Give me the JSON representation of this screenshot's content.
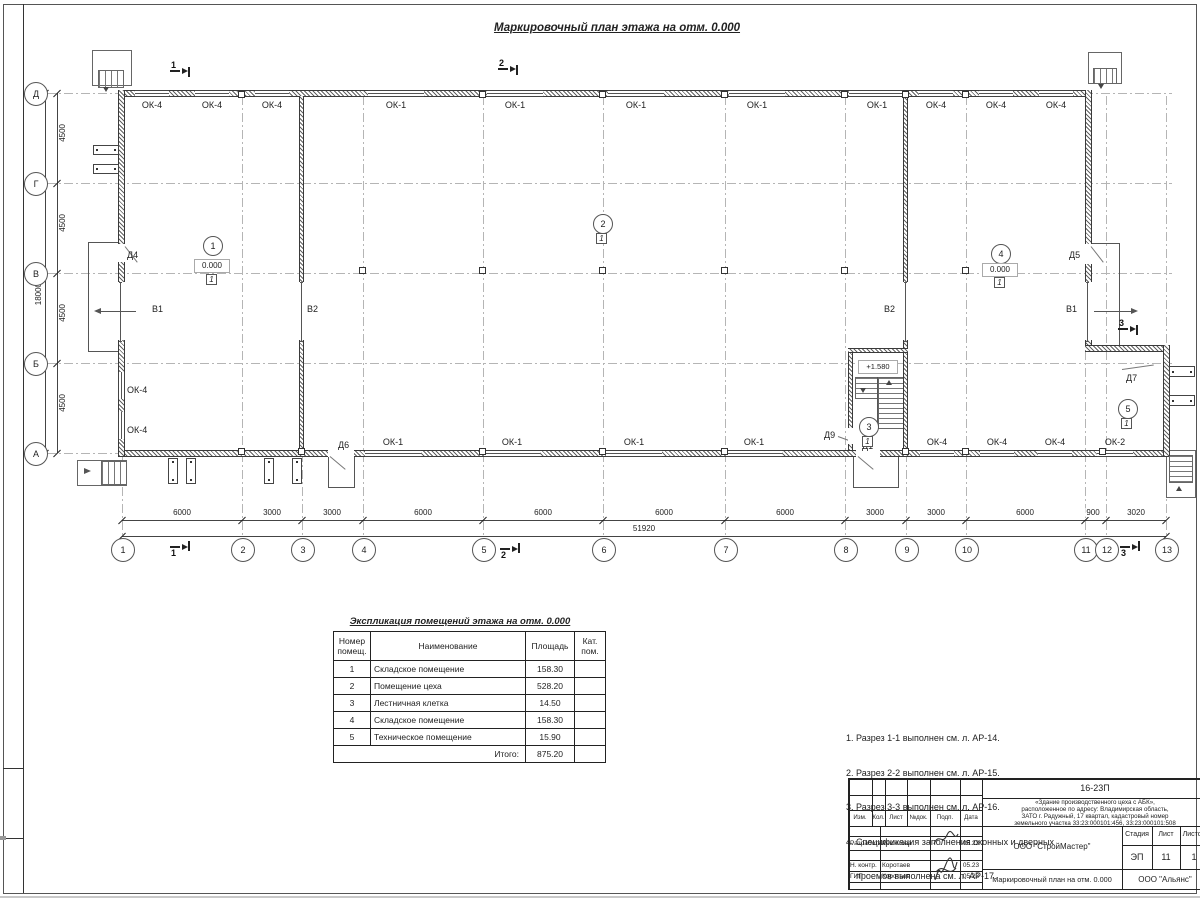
{
  "title": "Маркировочный план этажа на отм. 0.000",
  "plan": {
    "axes_rows": [
      "Д",
      "Г",
      "В",
      "Б",
      "А"
    ],
    "axes_cols": [
      "1",
      "2",
      "3",
      "4",
      "5",
      "6",
      "7",
      "8",
      "9",
      "10",
      "11",
      "12",
      "13"
    ],
    "dims_left": [
      "4500",
      "4500",
      "4500",
      "4500"
    ],
    "dim_left_total": "18000",
    "dims_bottom": [
      "6000",
      "3000",
      "3000",
      "6000",
      "6000",
      "6000",
      "6000",
      "3000",
      "3000",
      "6000",
      "900",
      "3020"
    ],
    "dim_bottom_total": "51920",
    "windows_top": [
      "ОК-4",
      "ОК-4",
      "ОК-4",
      "ОК-1",
      "ОК-1",
      "ОК-1",
      "ОК-1",
      "ОК-1",
      "ОК-4",
      "ОК-4",
      "ОК-4"
    ],
    "windows_bottom": [
      "ОК-1",
      "ОК-1",
      "ОК-1",
      "ОК-1",
      "ОК-4",
      "ОК-4",
      "ОК-4",
      "ОК-2"
    ],
    "windows_left": [
      "ОК-4",
      "ОК-4"
    ],
    "doors": {
      "d1": "Д1",
      "d4": "Д4",
      "d5": "Д5",
      "d6": "Д6",
      "d7": "Д7",
      "d9": "Д9"
    },
    "gate_b1": "В1",
    "gate_b2": "В2",
    "rooms": [
      {
        "num": "1",
        "elev": "0.000",
        "floor": "1"
      },
      {
        "num": "2",
        "floor": "1"
      },
      {
        "num": "3",
        "floor": "1"
      },
      {
        "num": "4",
        "elev": "0.000",
        "floor": "1"
      },
      {
        "num": "5",
        "floor": "1"
      }
    ],
    "stair_elev": "+1.580",
    "sections": {
      "s1": "1",
      "s2": "2",
      "s3": "3"
    }
  },
  "table": {
    "title": "Экспликация помещений этажа на отм. 0.000",
    "headers": {
      "num": "Номер помещ.",
      "name": "Наименование",
      "area": "Площадь",
      "cat": "Кат. пом."
    },
    "rows": [
      {
        "num": "1",
        "name": "Складское помещение",
        "area": "158.30"
      },
      {
        "num": "2",
        "name": "Помещение цеха",
        "area": "528.20"
      },
      {
        "num": "3",
        "name": "Лестничная клетка",
        "area": "14.50"
      },
      {
        "num": "4",
        "name": "Складское помещение",
        "area": "158.30"
      },
      {
        "num": "5",
        "name": "Техническое помещение",
        "area": "15.90"
      }
    ],
    "total_label": "Итого:",
    "total_value": "875.20"
  },
  "notes": [
    "1. Разрез 1-1 выполнен см. л. АР-14.",
    "2. Разрез 2-2 выполнен см. л. АР-15.",
    "3. Разрез 3-3 выполнен см. л. АР-16.",
    "4. Спецификация заполнения оконных и дверных",
    "    проемов выполнена см. л. АР-17.",
    "5. Экспликация полов выполнена см. л. АР-18."
  ],
  "titleblock": {
    "doc_number": "16-23П",
    "desc_lines": [
      "«Здание производственного цеха с АБК»,",
      "расположенное по адресу: Владимирская область,",
      "ЗАТО г. Радужный, 17 квартал, кадастровый номер",
      "земельного участка 33:23:000101:456, 33:23:000101:508"
    ],
    "header_cells": [
      "Изм.",
      "Кол.",
      "Лист",
      "№док.",
      "Подп.",
      "Дата"
    ],
    "rows": [
      {
        "role": "Разработал",
        "name": "Решетова",
        "date": "05.23"
      },
      {
        "role": "Н. контр.",
        "name": "Коротаев",
        "date": "05.23"
      },
      {
        "role": "ГИП",
        "name": "Коротаев",
        "date": "05.23"
      }
    ],
    "org": "ООО \"СтройМастер\"",
    "stage_label": "Стадия",
    "sheet_label": "Лист",
    "sheets_label": "Листов",
    "stage": "ЭП",
    "sheet": "11",
    "sheets": "1",
    "drawing_name": "Маркировочный план на отм. 0.000",
    "contractor": "ООО \"Альянс\""
  }
}
